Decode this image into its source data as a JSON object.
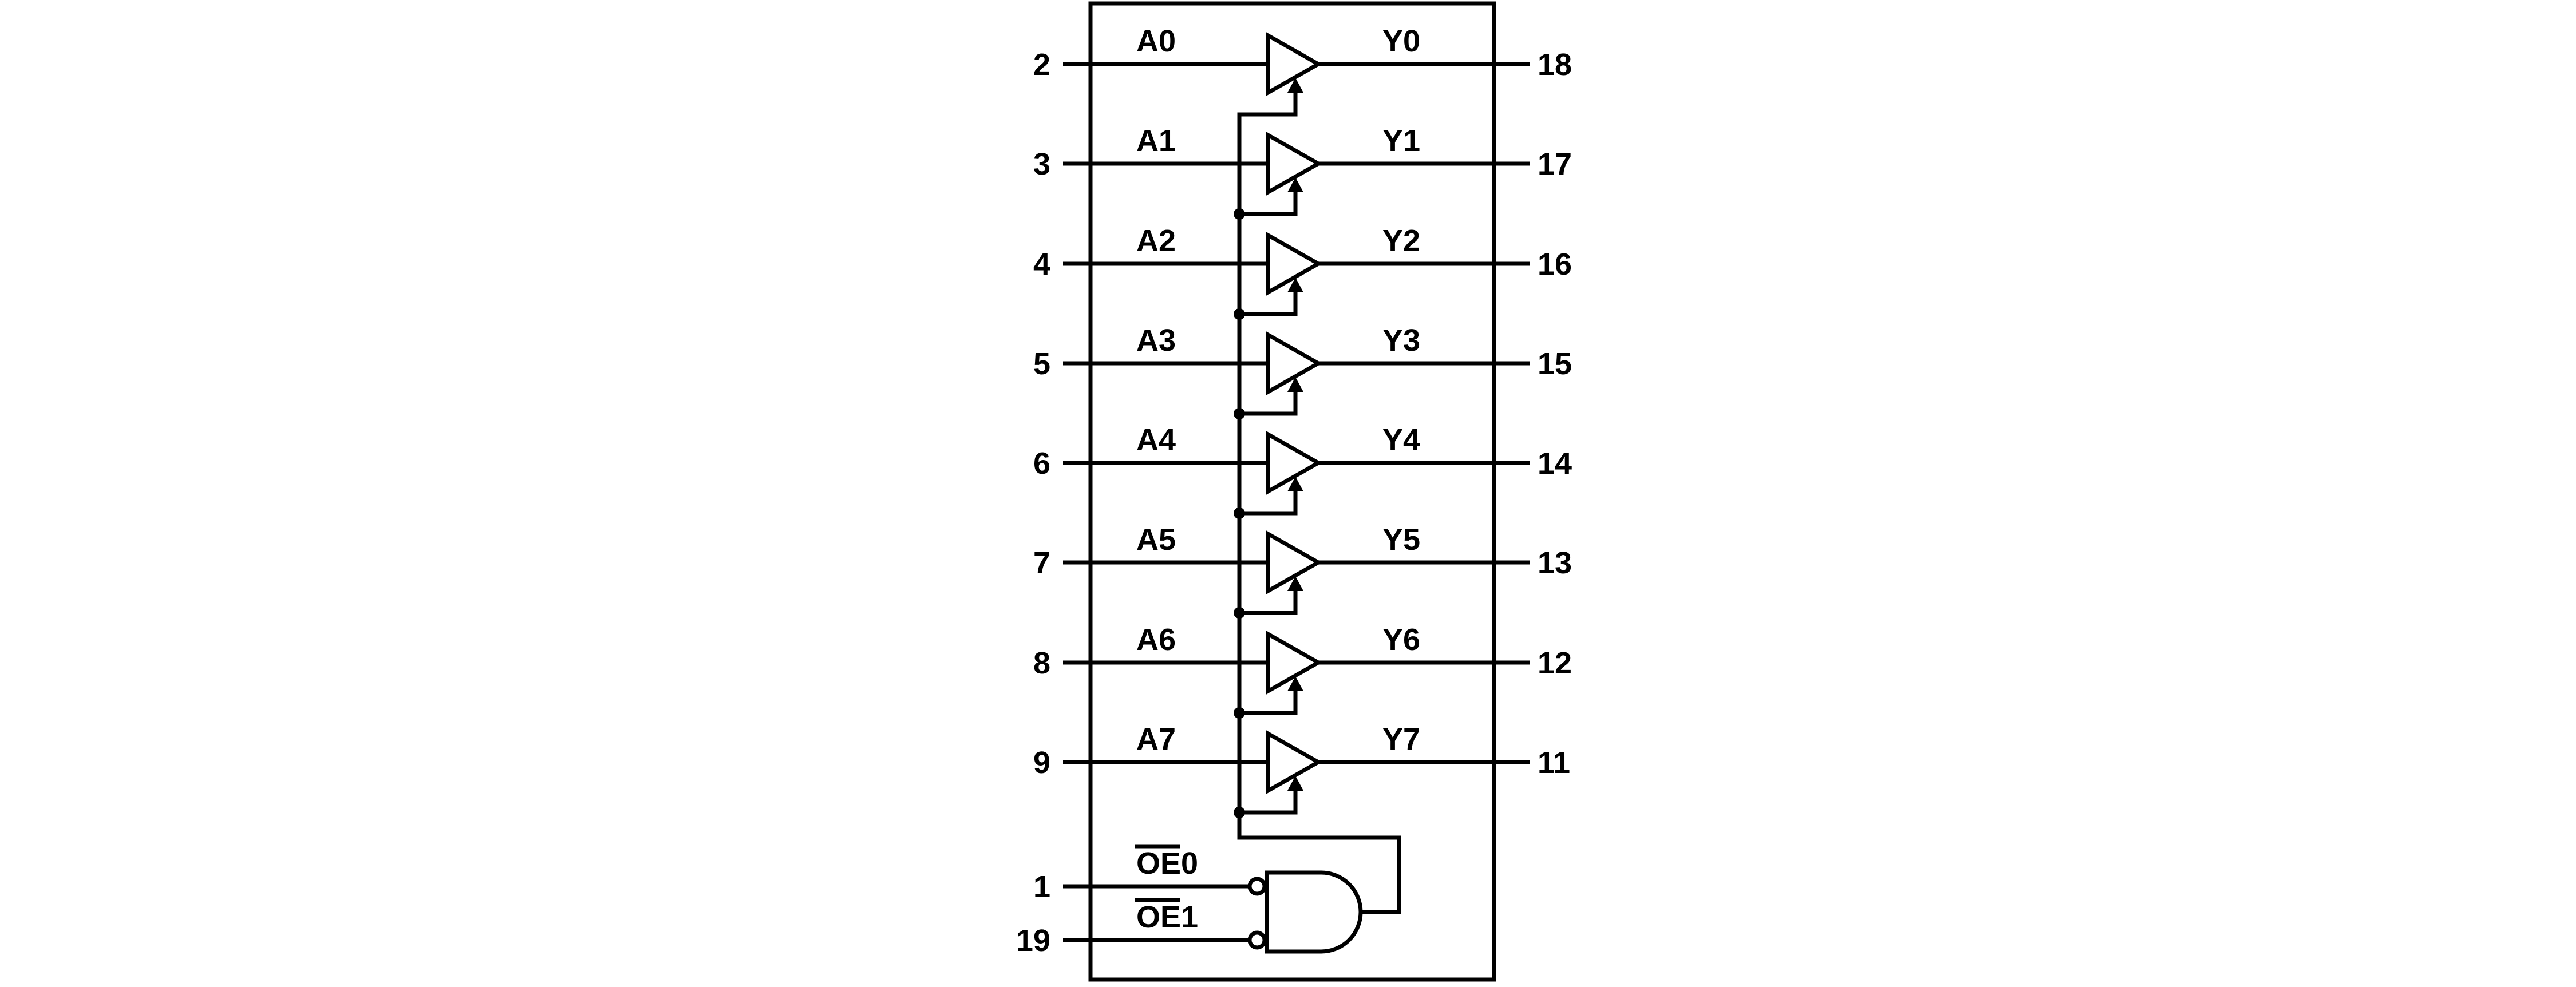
{
  "colors": {
    "ink": "#000000",
    "background": "#ffffff"
  },
  "ic": {
    "buffers": [
      {
        "input_pin": "2",
        "input_label": "A0",
        "output_label": "Y0",
        "output_pin": "18"
      },
      {
        "input_pin": "3",
        "input_label": "A1",
        "output_label": "Y1",
        "output_pin": "17"
      },
      {
        "input_pin": "4",
        "input_label": "A2",
        "output_label": "Y2",
        "output_pin": "16"
      },
      {
        "input_pin": "5",
        "input_label": "A3",
        "output_label": "Y3",
        "output_pin": "15"
      },
      {
        "input_pin": "6",
        "input_label": "A4",
        "output_label": "Y4",
        "output_pin": "14"
      },
      {
        "input_pin": "7",
        "input_label": "A5",
        "output_label": "Y5",
        "output_pin": "13"
      },
      {
        "input_pin": "8",
        "input_label": "A6",
        "output_label": "Y6",
        "output_pin": "12"
      },
      {
        "input_pin": "9",
        "input_label": "A7",
        "output_label": "Y7",
        "output_pin": "11"
      }
    ],
    "output_enable": {
      "inputs": [
        {
          "pin": "1",
          "label": "OE0",
          "overlined_part": "OE"
        },
        {
          "pin": "19",
          "label": "OE1",
          "overlined_part": "OE"
        }
      ]
    }
  }
}
